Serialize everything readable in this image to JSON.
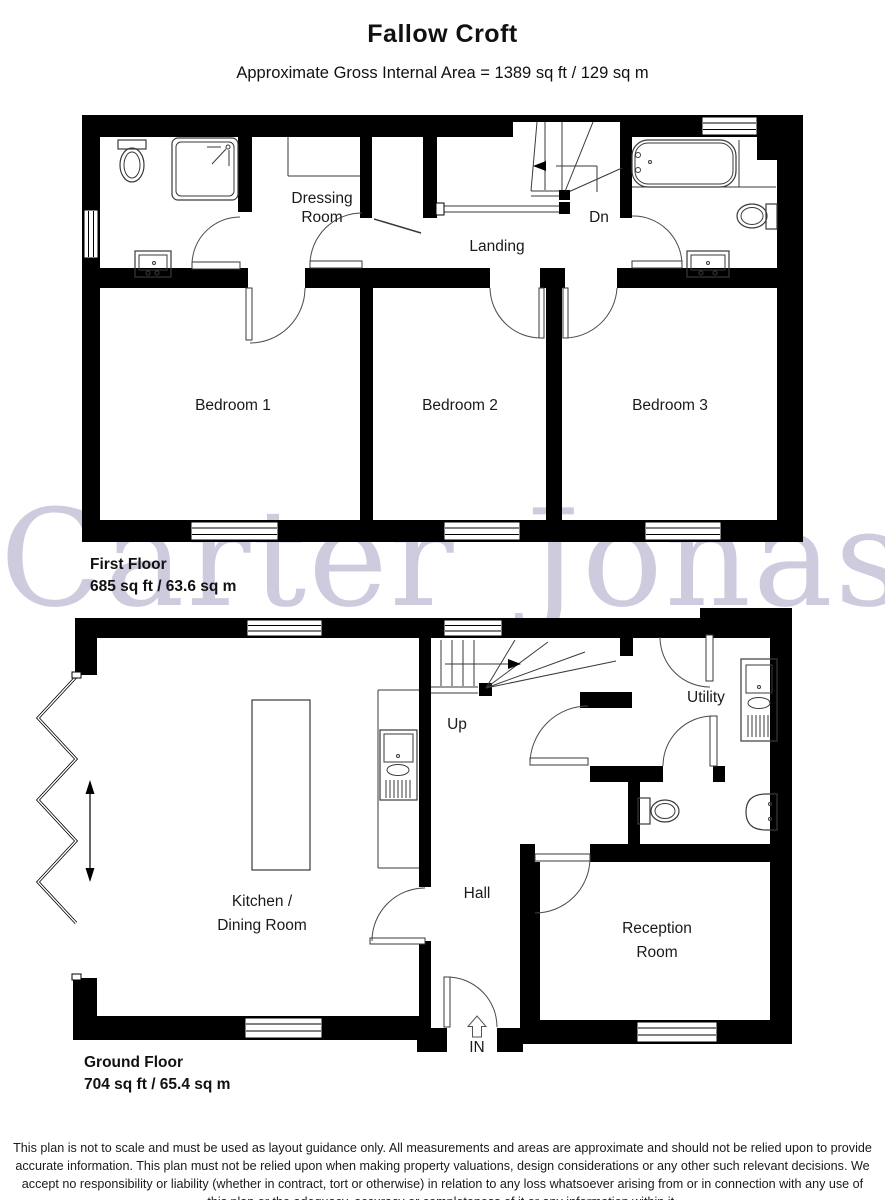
{
  "header": {
    "title": "Fallow Croft",
    "subtitle": "Approximate Gross Internal Area = 1389 sq ft / 129 sq m"
  },
  "watermark": "Carter Jonas",
  "first_floor": {
    "name": "First Floor",
    "area": "685 sq ft / 63.6 sq m",
    "labels": {
      "dressing_room_line1": "Dressing",
      "dressing_room_line2": "Room",
      "landing": "Landing",
      "stairs_down": "Dn",
      "bedroom_1": "Bedroom 1",
      "bedroom_2": "Bedroom 2",
      "bedroom_3": "Bedroom 3"
    }
  },
  "ground_floor": {
    "name": "Ground Floor",
    "area": "704 sq ft / 65.4 sq m",
    "labels": {
      "kitchen_line1": "Kitchen /",
      "kitchen_line2": "Dining Room",
      "hall": "Hall",
      "utility": "Utility",
      "reception_line1": "Reception",
      "reception_line2": "Room",
      "stairs_up": "Up",
      "entrance": "IN"
    }
  },
  "disclaimer": "This plan is not to scale and must be used as layout guidance only. All measurements and areas are approximate and should not be relied upon to provide accurate information. This plan must not be relied upon when making property valuations, design considerations or any other such relevant decisions. We accept no responsibility or liability (whether in contract, tort or otherwise) in relation to any loss whatsoever arising from or in connection with any use of this plan or the adequacy, accuracy or completeness of it or any information within it.",
  "colors": {
    "walls": "#000000",
    "watermark": "#c5bfd7",
    "lines": "#3a3a3a"
  }
}
